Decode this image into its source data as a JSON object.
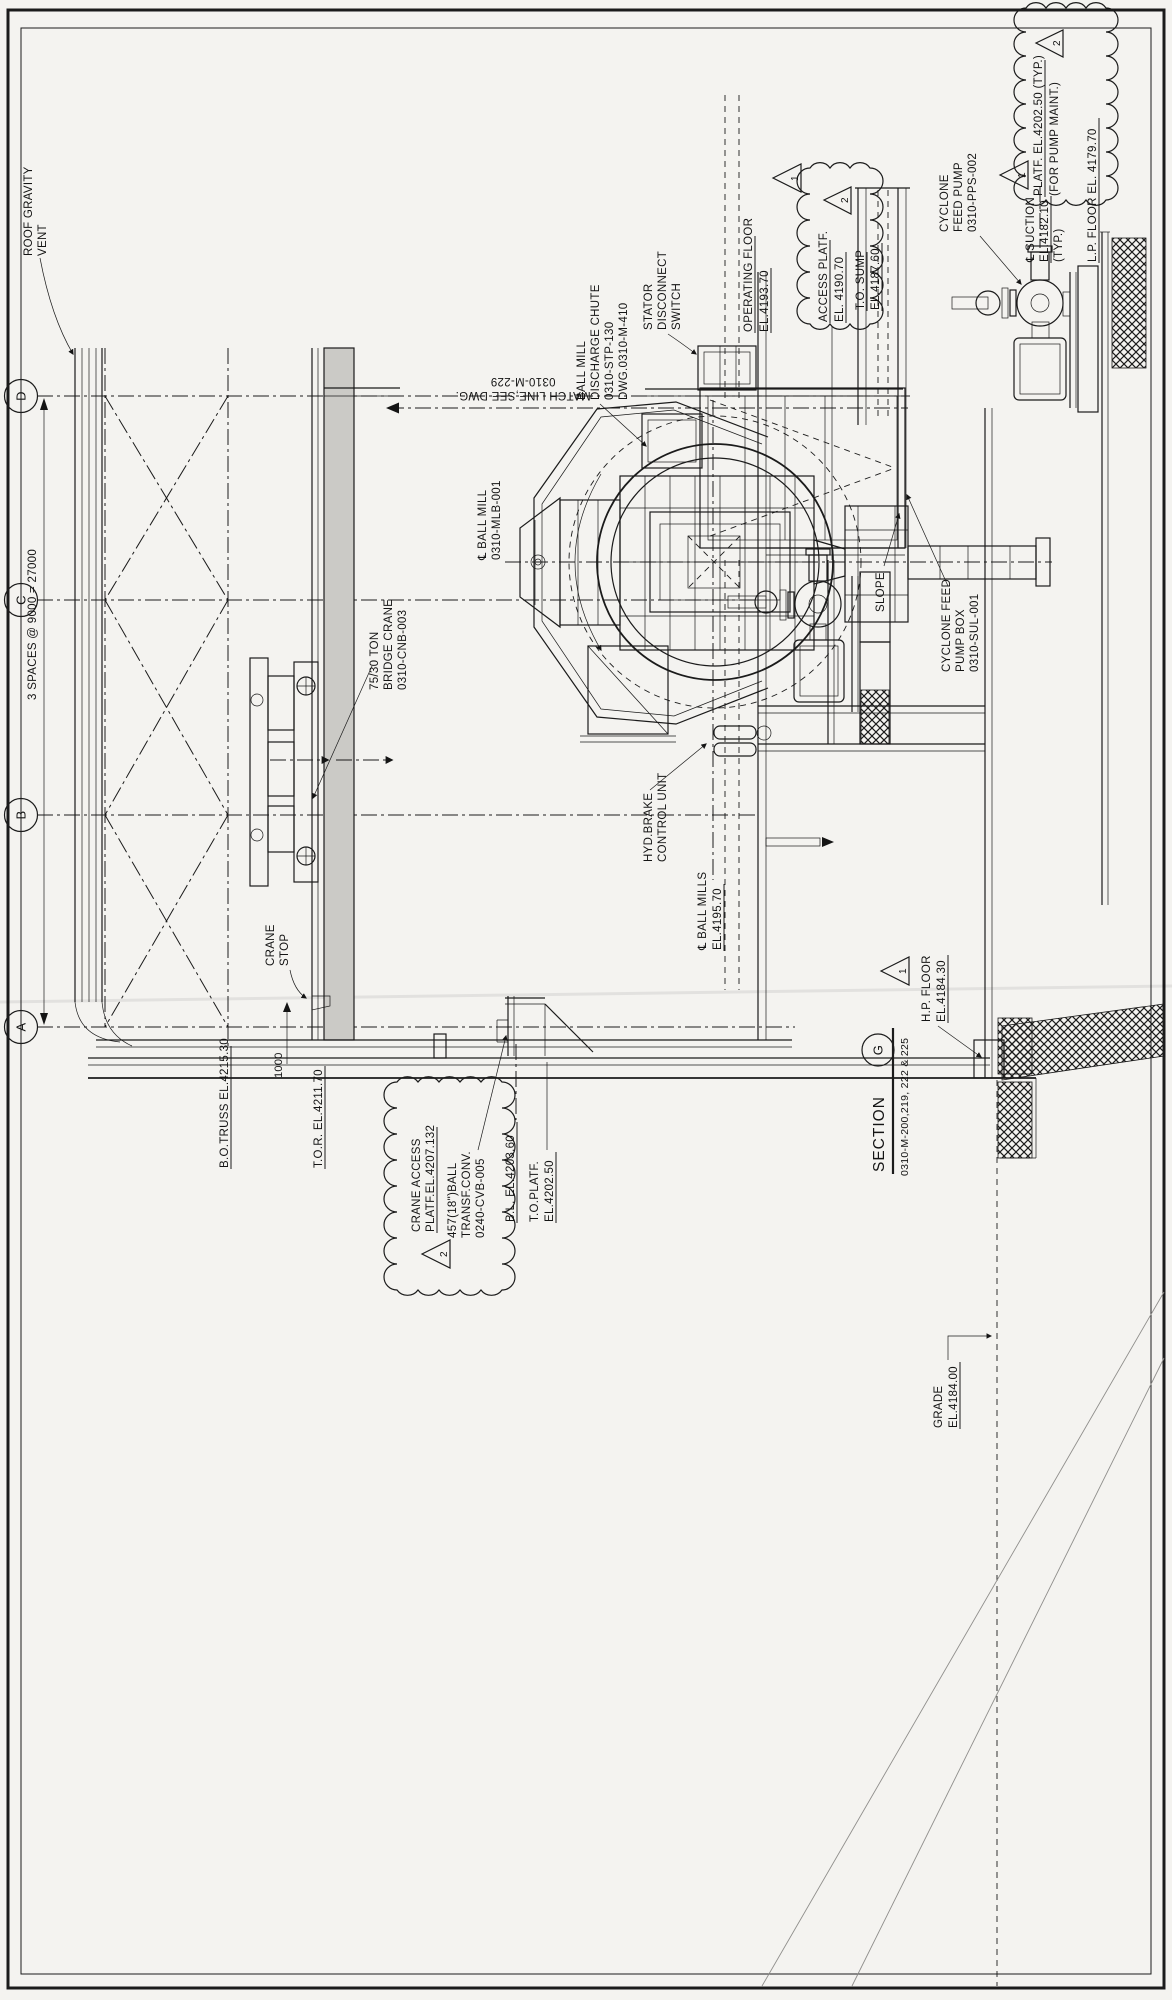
{
  "sheet": {
    "type": "engineering-section-drawing",
    "orientation": "rotated-90",
    "colors": {
      "paper": "#f4f3f0",
      "ink": "#1b1b1b",
      "girder_fill": "#cbcac6"
    }
  },
  "title": {
    "section": "SECTION",
    "section_letter": "G",
    "dwg_refs": "0310-M-200,219, 222 & 225"
  },
  "grid": {
    "bubbles": [
      "D",
      "C",
      "B",
      "A"
    ],
    "spacing_note": "3 SPACES @ 9000 = 27000"
  },
  "revisions": {
    "rev1": "1",
    "rev2": "2"
  },
  "labels": {
    "roof1": "ROOF GRAVITY",
    "roof2": "VENT",
    "spaces": "3 SPACES @ 9000 = 27000",
    "match1": "MATCH LINE,SEE DWG.",
    "match2": "0310-M-229",
    "mill1": "℄ BALL MILL",
    "mill2": "0310-MLB-001",
    "chute1": "BALL MILL",
    "chute2": "DISCHARGE CHUTE",
    "chute3": "0310-STP-130",
    "chute4": "DWG.0310-M-410",
    "stator1": "STATOR",
    "stator2": "DISCONNECT",
    "stator3": "SWITCH",
    "opfloor1": "OPERATING FLOOR",
    "opfloor2": "EL.4193.70",
    "accplat1": "ACCESS PLATF.",
    "accplat2": "EL. 4190.70",
    "sump1": "T.O. SUMP",
    "sump2": "EL.4187.60",
    "cfp1": "CYCLONE",
    "cfp2": "FEED PUMP",
    "cfp3": "0310-PPS-002",
    "suct1": "℄ SUCTION",
    "suct2": "EL.4182.10",
    "suct3": "(TYP.)",
    "pmaint1": "PLATF. EL.4202.50 (TYP.)",
    "pmaint2": "(FOR PUMP MAINT.)",
    "lpfloor": "L.P. FLOOR EL. 4179.70",
    "crane1": "75/30 TON",
    "crane2": "BRIDGE CRANE",
    "crane3": "0310-CNB-003",
    "hyd1": "HYD.BRAKE",
    "hyd2": "CONTROL UNIT",
    "millscl1": "℄ BALL MILLS",
    "millscl2": "EL.4195.70",
    "cranestop1": "CRANE",
    "cranestop2": "STOP",
    "dim1000": "1000",
    "botruss": "B.O.TRUSS EL.4215.30",
    "tor": "T.O.R. EL.4211.70",
    "cracc1": "CRANE ACCESS",
    "cracc2": "PLATF.EL.4207.132",
    "conv1": "457(18\")BALL",
    "conv2": "TRANSF.CONV.",
    "conv3": "0240-CVB-005",
    "bl": "B.L. EL.4203.60",
    "toplatf1": "T.O.PLATF.",
    "toplatf2": "EL.4202.50",
    "pbox1": "CYCLONE FEED",
    "pbox2": "PUMP BOX",
    "pbox3": "0310-SUL-001",
    "hpfloor1": "H.P. FLOOR",
    "hpfloor2": "EL.4184.30",
    "grade1": "GRADE",
    "grade2": "EL.4184.00",
    "slope": "SLOPE",
    "gridD": "D",
    "gridC": "C",
    "gridB": "B",
    "gridA": "A"
  }
}
